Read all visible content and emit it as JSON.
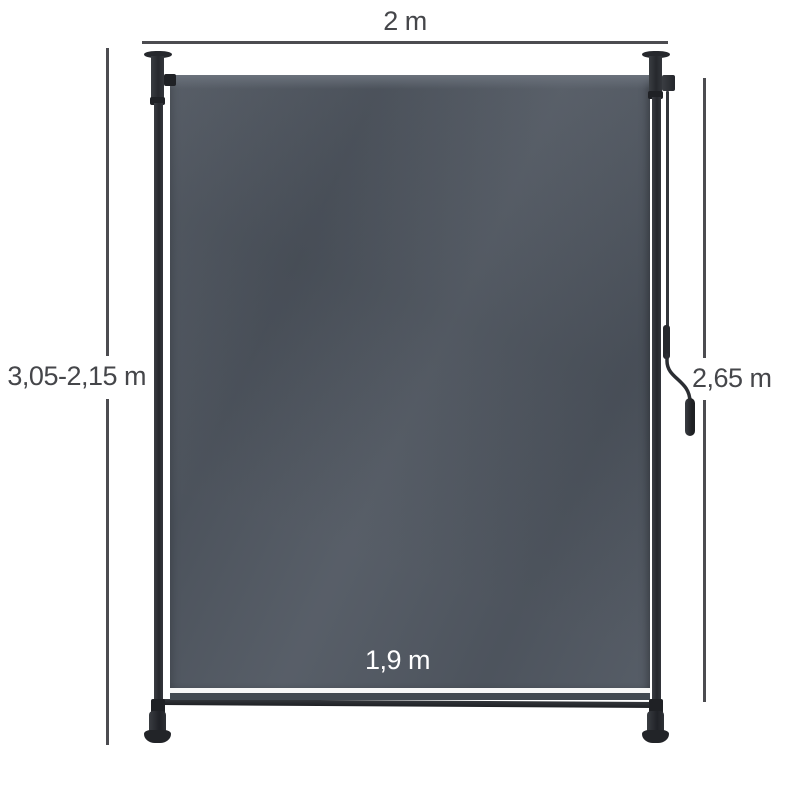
{
  "dimensions": {
    "top_width": {
      "label": "2 m"
    },
    "left_height": {
      "label": "3,05-2,15 m"
    },
    "right_height": {
      "label": "2,65 m"
    },
    "fabric_width": {
      "label": "1,9 m"
    }
  },
  "colors": {
    "background": "#ffffff",
    "dimension_line": "#4c4c50",
    "dimension_text": "#45464a",
    "fabric": "#4e555f",
    "fabric_dark": "#424951",
    "fabric_highlight": "#6b727c",
    "frame": "#26282d",
    "frame_light": "#3a3d42",
    "stripe": "#f7f7f7",
    "label_on_fabric": "#ffffff"
  }
}
